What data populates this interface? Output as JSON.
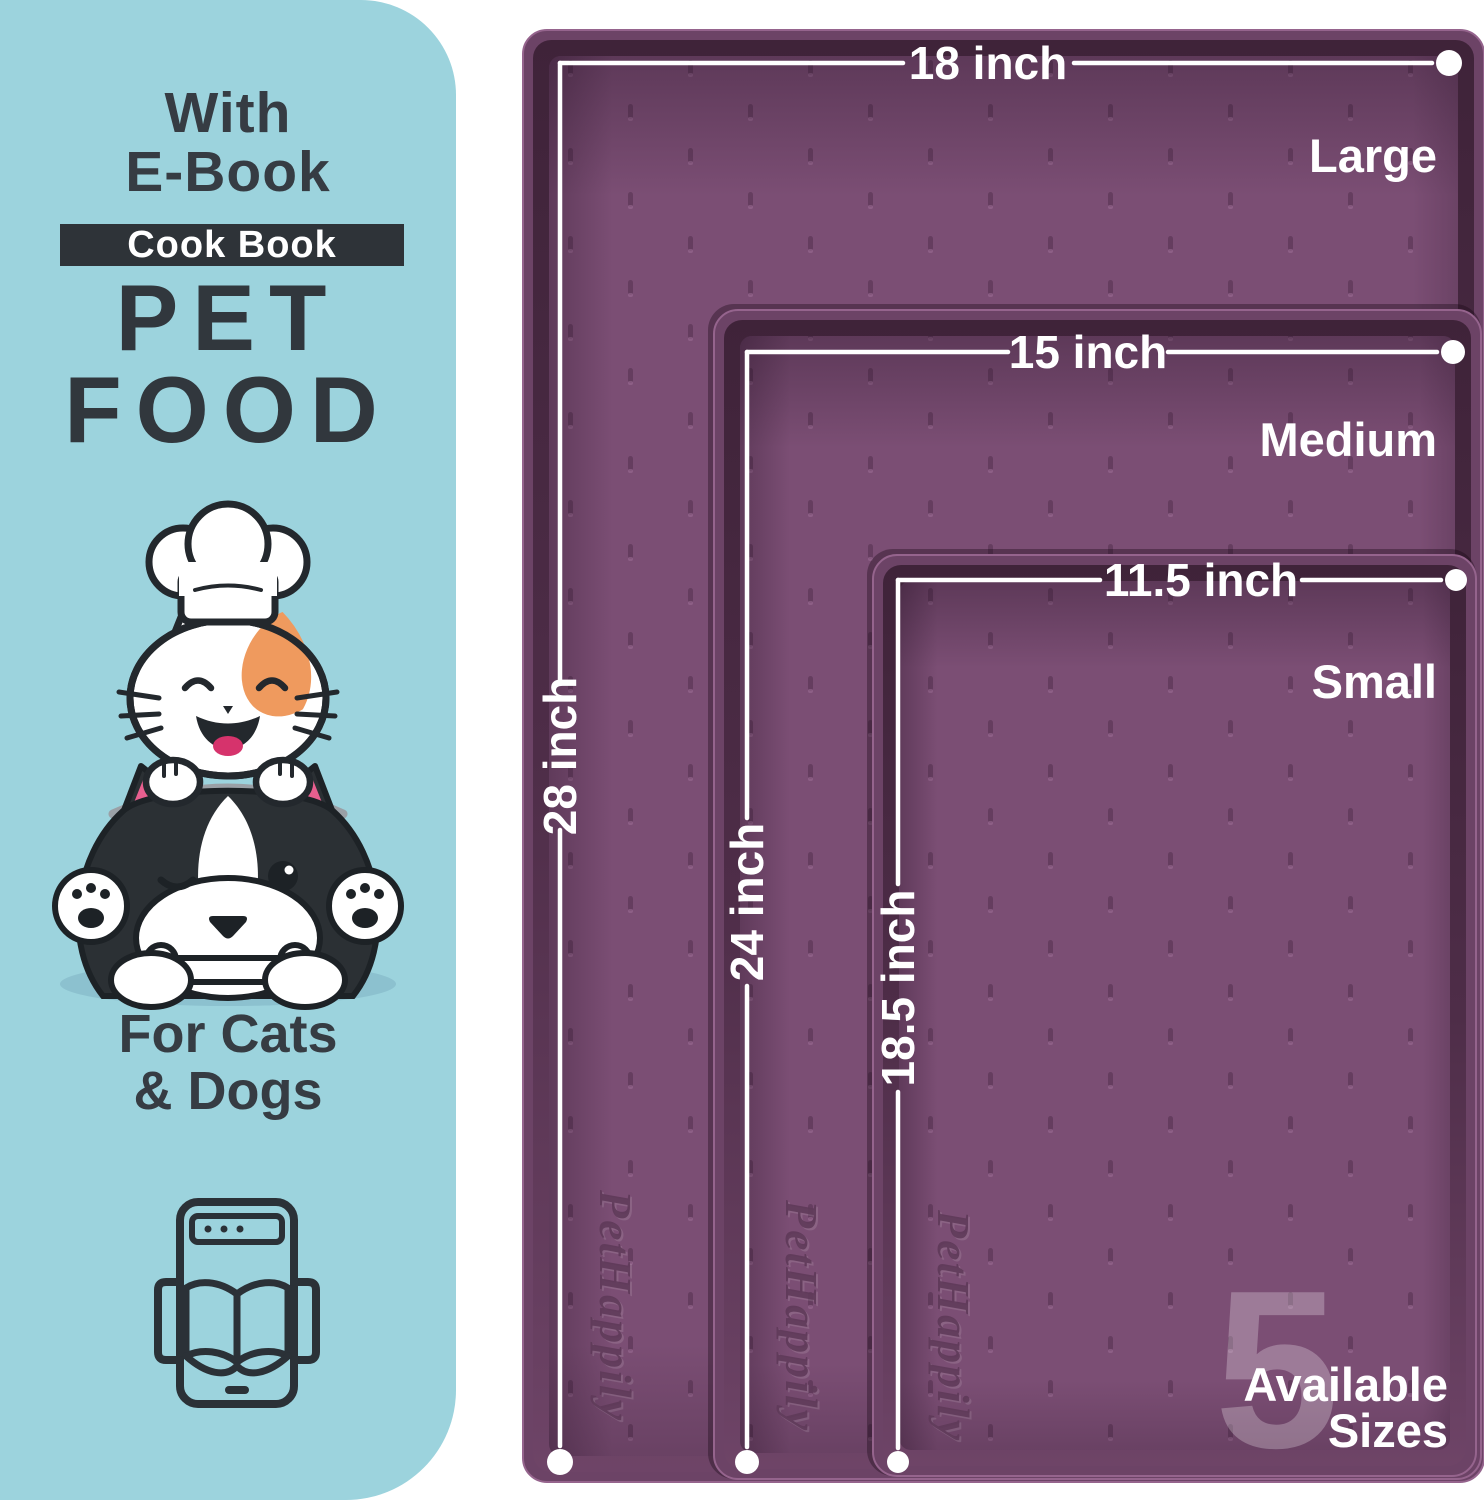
{
  "panel": {
    "ebook_line1": "With",
    "ebook_line2": "E-Book",
    "badge_label": "Cook Book",
    "title_line1": "PET",
    "title_line2": "FOOD",
    "audience_line1": "For Cats",
    "audience_line2": "& Dogs"
  },
  "mats": [
    {
      "size_label": "Large",
      "width_label": "18 inch",
      "length_label": "28 inch"
    },
    {
      "size_label": "Medium",
      "width_label": "15 inch",
      "length_label": "24 inch"
    },
    {
      "size_label": "Small",
      "width_label": "11.5 inch",
      "length_label": "18.5 inch"
    }
  ],
  "availability": {
    "count": "5",
    "word1": "Available",
    "word2": "Sizes"
  },
  "brand_embossed": "PetHappily",
  "colors": {
    "panel_blue": "#9cd3dd",
    "mat_interior": "#7b4e74",
    "mat_rim": "#6c4366",
    "mat_rim_shadow": "#4c2c46",
    "text_dark": "#31373d",
    "badge_dark": "#2e3338",
    "line_white": "#ffffff",
    "accent_pink": "#e85f8f",
    "accent_orange": "#ef9a5e",
    "tongue_pink": "#d6336c"
  }
}
